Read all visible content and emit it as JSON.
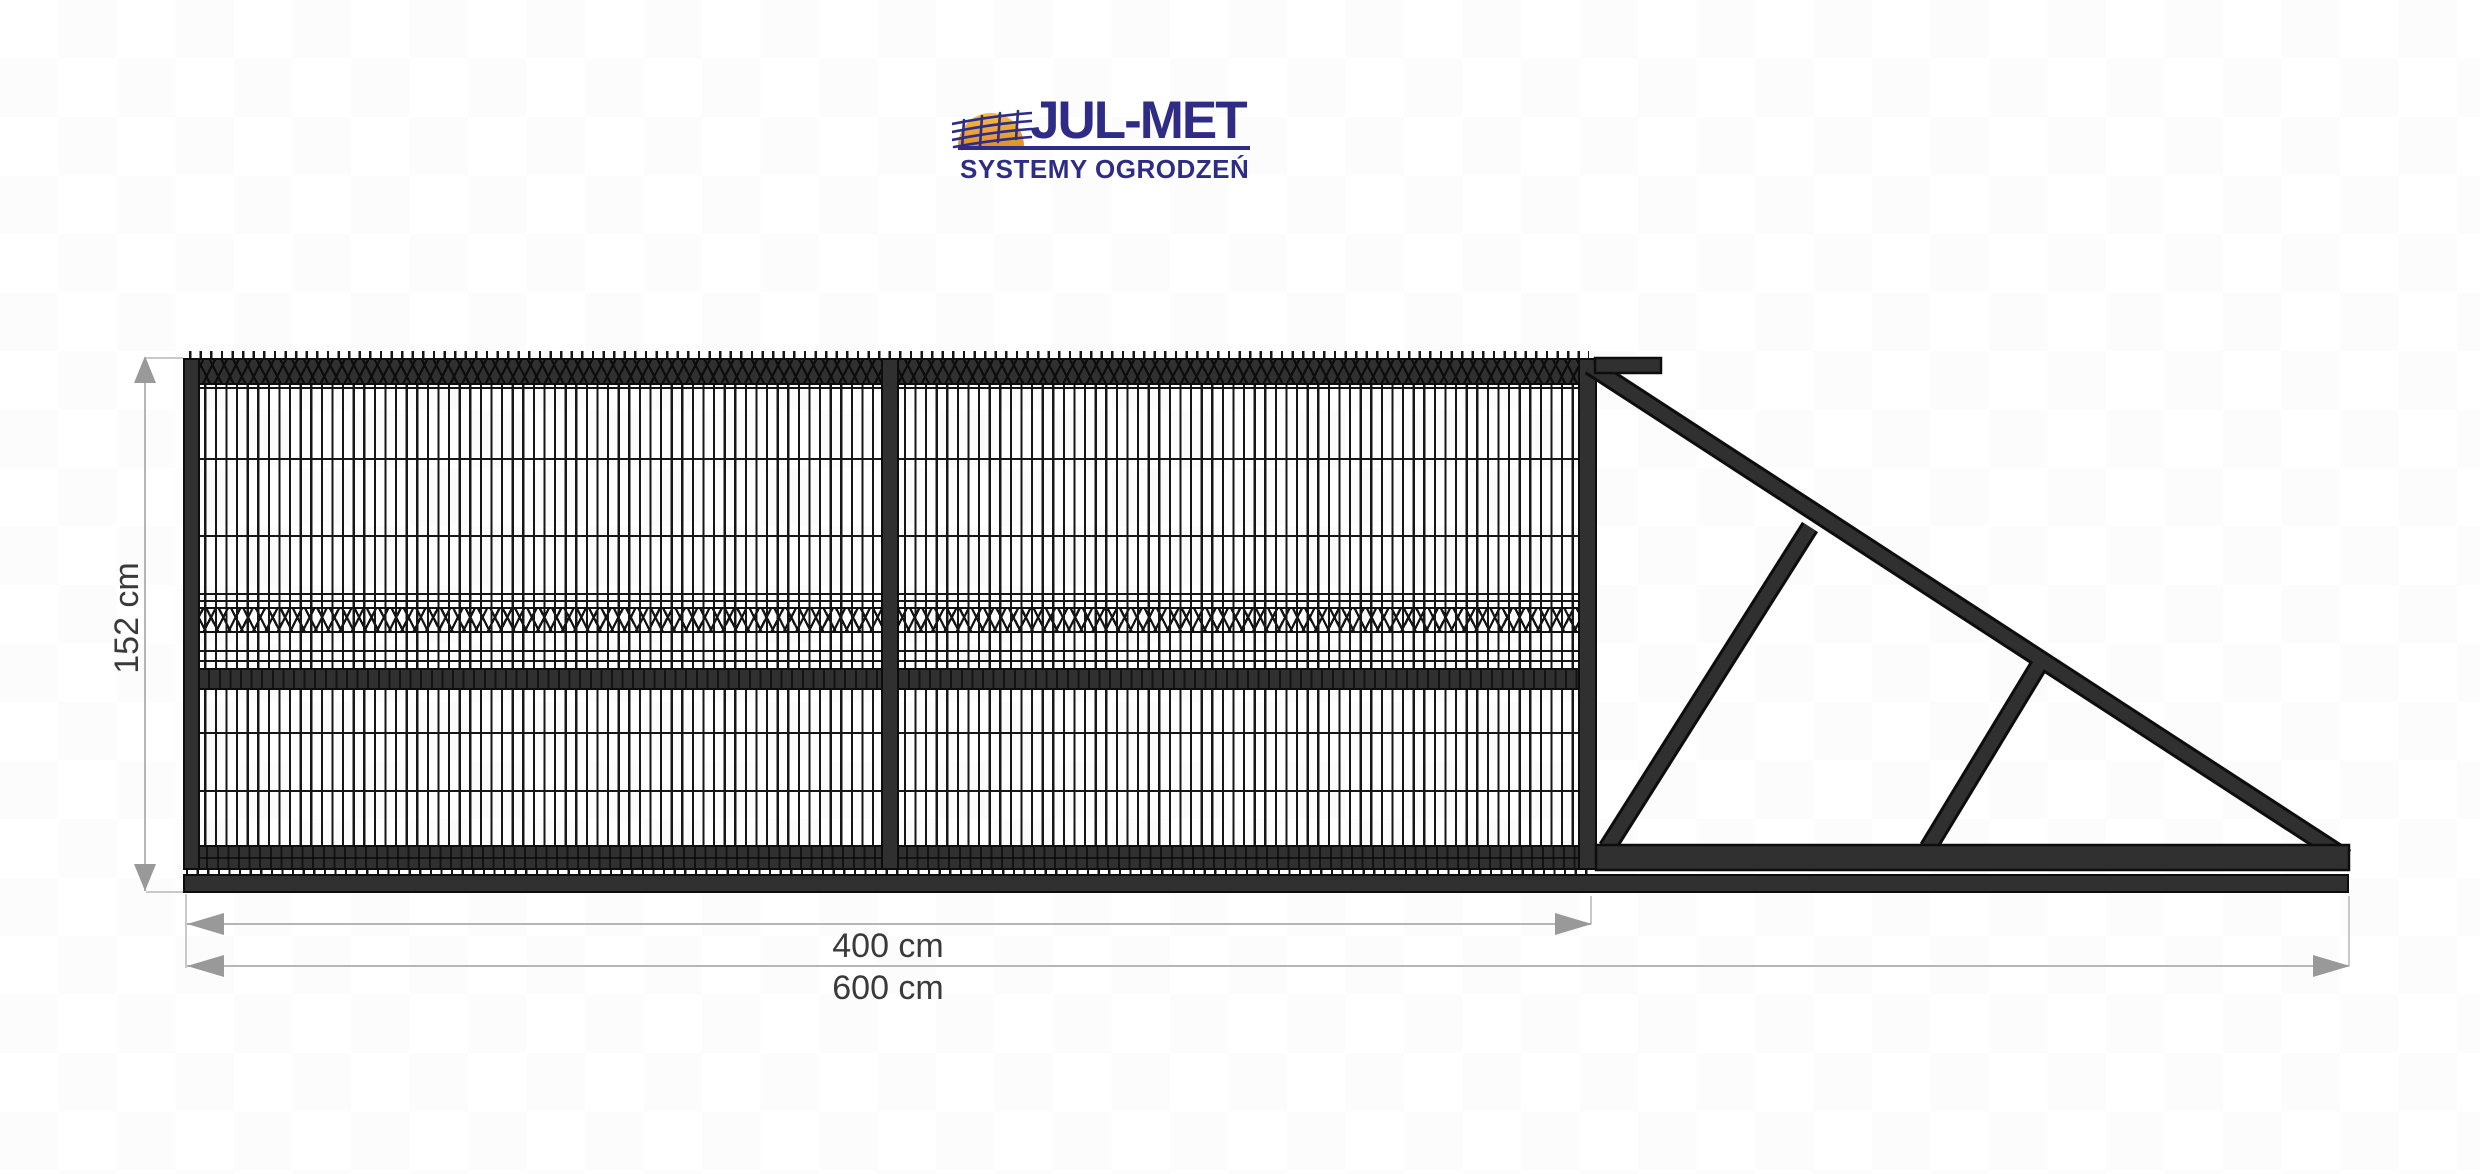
{
  "logo": {
    "title": "JUL-MET",
    "tagline": "SYSTEMY OGRODZEŃ",
    "colors": {
      "navy": "#2e2c85",
      "sun_yellow": "#f6bc45",
      "sun_orange": "#e0922c"
    }
  },
  "drawing": {
    "gate_height_cm": 152,
    "leaf_width_cm": 400,
    "total_length_cm": 600,
    "labels": {
      "height": "152 cm",
      "leaf_width": "400 cm",
      "total_width": "600 cm"
    },
    "colors": {
      "steel": "#303030",
      "outline": "#0d0d0d",
      "dimension_line": "#b6b6b6",
      "arrowhead": "#999999",
      "label_text": "#3a3a3a",
      "background": "#ffffff",
      "background_check": "#fcfcfc"
    }
  }
}
